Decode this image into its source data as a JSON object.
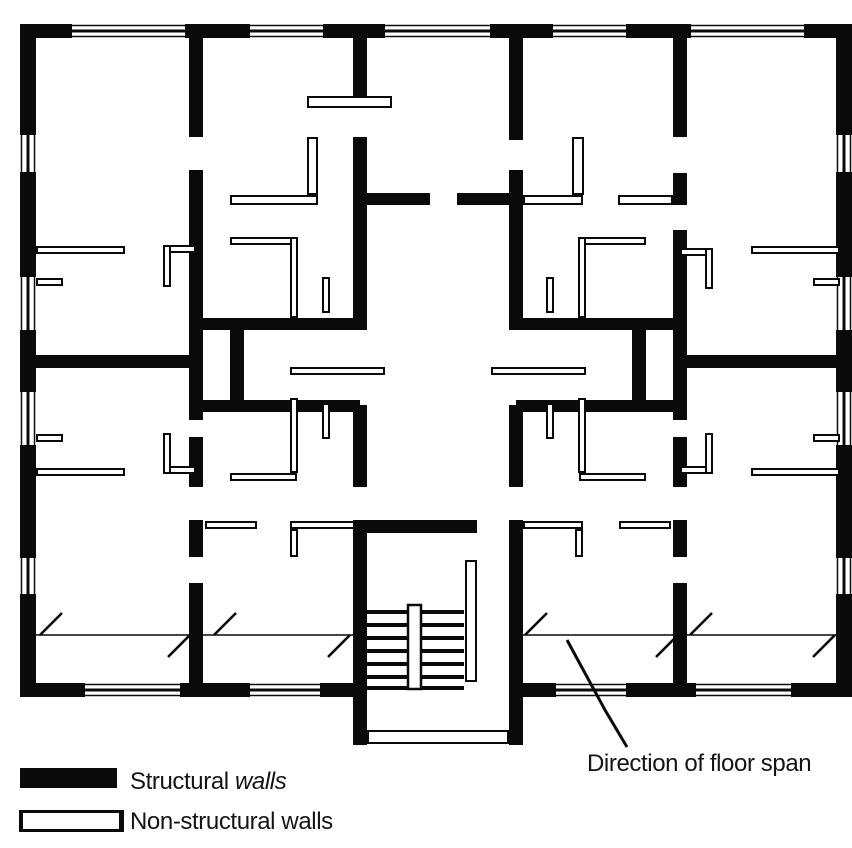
{
  "canvas": {
    "w": 852,
    "h": 848,
    "wall_color": "#0a0a0a",
    "bg": "#ffffff"
  },
  "annotation": {
    "label": "Direction of floor span"
  },
  "legend": {
    "structural": {
      "label_regular": "Structural ",
      "label_italic": "walls"
    },
    "nonstructural": {
      "label": "Non-structural walls"
    }
  },
  "plan": {
    "structural_walls": [
      [
        20,
        24,
        52,
        14
      ],
      [
        185,
        24,
        65,
        14
      ],
      [
        323,
        24,
        62,
        14
      ],
      [
        490,
        24,
        63,
        14
      ],
      [
        626,
        24,
        65,
        14
      ],
      [
        804,
        24,
        48,
        14
      ],
      [
        20,
        24,
        16,
        111
      ],
      [
        20,
        172,
        16,
        105
      ],
      [
        20,
        330,
        16,
        62
      ],
      [
        20,
        445,
        16,
        113
      ],
      [
        20,
        594,
        16,
        103
      ],
      [
        836,
        24,
        16,
        111
      ],
      [
        836,
        172,
        16,
        105
      ],
      [
        836,
        330,
        16,
        62
      ],
      [
        836,
        445,
        16,
        113
      ],
      [
        836,
        594,
        16,
        103
      ],
      [
        20,
        683,
        65,
        14
      ],
      [
        180,
        683,
        70,
        14
      ],
      [
        320,
        683,
        47,
        14
      ],
      [
        509,
        683,
        47,
        14
      ],
      [
        626,
        683,
        70,
        14
      ],
      [
        791,
        683,
        61,
        14
      ],
      [
        189,
        38,
        14,
        99
      ],
      [
        189,
        170,
        14,
        250
      ],
      [
        189,
        437,
        14,
        50
      ],
      [
        189,
        520,
        14,
        37
      ],
      [
        189,
        583,
        14,
        100
      ],
      [
        673,
        38,
        14,
        99
      ],
      [
        673,
        173,
        14,
        32
      ],
      [
        673,
        230,
        14,
        190
      ],
      [
        673,
        437,
        14,
        50
      ],
      [
        673,
        520,
        14,
        37
      ],
      [
        673,
        583,
        14,
        100
      ],
      [
        353,
        38,
        14,
        58
      ],
      [
        353,
        137,
        14,
        193
      ],
      [
        353,
        405,
        14,
        82
      ],
      [
        509,
        38,
        14,
        102
      ],
      [
        509,
        170,
        14,
        160
      ],
      [
        509,
        405,
        14,
        82
      ],
      [
        353,
        520,
        14,
        225
      ],
      [
        509,
        520,
        14,
        225
      ],
      [
        230,
        324,
        14,
        82
      ],
      [
        632,
        324,
        14,
        82
      ],
      [
        360,
        193,
        70,
        12
      ],
      [
        457,
        193,
        59,
        12
      ],
      [
        196,
        318,
        164,
        12
      ],
      [
        516,
        318,
        164,
        12
      ],
      [
        196,
        400,
        164,
        12
      ],
      [
        516,
        400,
        164,
        12
      ],
      [
        36,
        355,
        153,
        13
      ],
      [
        687,
        355,
        149,
        13
      ],
      [
        360,
        520,
        117,
        13
      ]
    ],
    "nonstructural_walls": [
      [
        307,
        96,
        85,
        12
      ],
      [
        307,
        137,
        11,
        58
      ],
      [
        230,
        195,
        88,
        10
      ],
      [
        572,
        137,
        12,
        58
      ],
      [
        523,
        195,
        60,
        10
      ],
      [
        618,
        195,
        55,
        10
      ],
      [
        36,
        246,
        89,
        8
      ],
      [
        751,
        246,
        89,
        8
      ],
      [
        36,
        278,
        27,
        8
      ],
      [
        813,
        278,
        27,
        8
      ],
      [
        163,
        245,
        33,
        8
      ],
      [
        163,
        245,
        8,
        42
      ],
      [
        680,
        248,
        33,
        8
      ],
      [
        705,
        248,
        8,
        41
      ],
      [
        230,
        237,
        67,
        8
      ],
      [
        290,
        237,
        8,
        81
      ],
      [
        579,
        237,
        67,
        8
      ],
      [
        578,
        237,
        8,
        81
      ],
      [
        322,
        277,
        8,
        36
      ],
      [
        546,
        277,
        8,
        36
      ],
      [
        290,
        367,
        95,
        8
      ],
      [
        491,
        367,
        95,
        8
      ],
      [
        163,
        466,
        33,
        8
      ],
      [
        163,
        433,
        8,
        41
      ],
      [
        680,
        466,
        33,
        8
      ],
      [
        705,
        433,
        8,
        41
      ],
      [
        230,
        473,
        67,
        8
      ],
      [
        290,
        398,
        8,
        75
      ],
      [
        579,
        473,
        67,
        8
      ],
      [
        578,
        398,
        8,
        75
      ],
      [
        322,
        403,
        8,
        36
      ],
      [
        546,
        403,
        8,
        36
      ],
      [
        36,
        434,
        27,
        8
      ],
      [
        813,
        434,
        27,
        8
      ],
      [
        36,
        468,
        89,
        8
      ],
      [
        751,
        468,
        89,
        8
      ],
      [
        205,
        521,
        52,
        8
      ],
      [
        290,
        521,
        65,
        8
      ],
      [
        290,
        529,
        8,
        28
      ],
      [
        619,
        521,
        52,
        8
      ],
      [
        523,
        521,
        60,
        8
      ],
      [
        575,
        529,
        8,
        28
      ],
      [
        465,
        560,
        12,
        122
      ],
      [
        367,
        730,
        142,
        14
      ]
    ],
    "windows": [
      {
        "r": [
          72,
          24,
          113,
          14
        ],
        "o": "h"
      },
      {
        "r": [
          250,
          24,
          73,
          14
        ],
        "o": "h"
      },
      {
        "r": [
          385,
          24,
          105,
          14
        ],
        "o": "h"
      },
      {
        "r": [
          553,
          24,
          73,
          14
        ],
        "o": "h"
      },
      {
        "r": [
          691,
          24,
          113,
          14
        ],
        "o": "h"
      },
      {
        "r": [
          85,
          683,
          95,
          14
        ],
        "o": "h"
      },
      {
        "r": [
          250,
          683,
          70,
          14
        ],
        "o": "h"
      },
      {
        "r": [
          556,
          683,
          70,
          14
        ],
        "o": "h"
      },
      {
        "r": [
          696,
          683,
          95,
          14
        ],
        "o": "h"
      },
      {
        "r": [
          20,
          135,
          16,
          37
        ],
        "o": "v"
      },
      {
        "r": [
          20,
          277,
          16,
          53
        ],
        "o": "v"
      },
      {
        "r": [
          20,
          392,
          16,
          53
        ],
        "o": "v"
      },
      {
        "r": [
          20,
          558,
          16,
          36
        ],
        "o": "v"
      },
      {
        "r": [
          836,
          135,
          16,
          37
        ],
        "o": "v"
      },
      {
        "r": [
          836,
          277,
          16,
          53
        ],
        "o": "v"
      },
      {
        "r": [
          836,
          392,
          16,
          53
        ],
        "o": "v"
      },
      {
        "r": [
          836,
          558,
          16,
          36
        ],
        "o": "v"
      }
    ],
    "stairs": {
      "tread_x1": 363,
      "tread_x2": 464,
      "tread_ys": [
        612,
        625,
        638,
        651,
        664,
        677,
        688
      ],
      "stringer": [
        408,
        605,
        13,
        84
      ]
    },
    "span_lines": [
      [
        36,
        635,
        353,
        635
      ],
      [
        523,
        635,
        836,
        635
      ]
    ],
    "span_ticks": [
      [
        40,
        635,
        62,
        613
      ],
      [
        214,
        635,
        236,
        613
      ],
      [
        525,
        635,
        547,
        613
      ],
      [
        690,
        635,
        712,
        613
      ],
      [
        168,
        657,
        190,
        635
      ],
      [
        328,
        657,
        350,
        635
      ],
      [
        656,
        657,
        678,
        635
      ],
      [
        813,
        657,
        835,
        635
      ]
    ],
    "leader_points": "567,640 605,710 627,747"
  }
}
